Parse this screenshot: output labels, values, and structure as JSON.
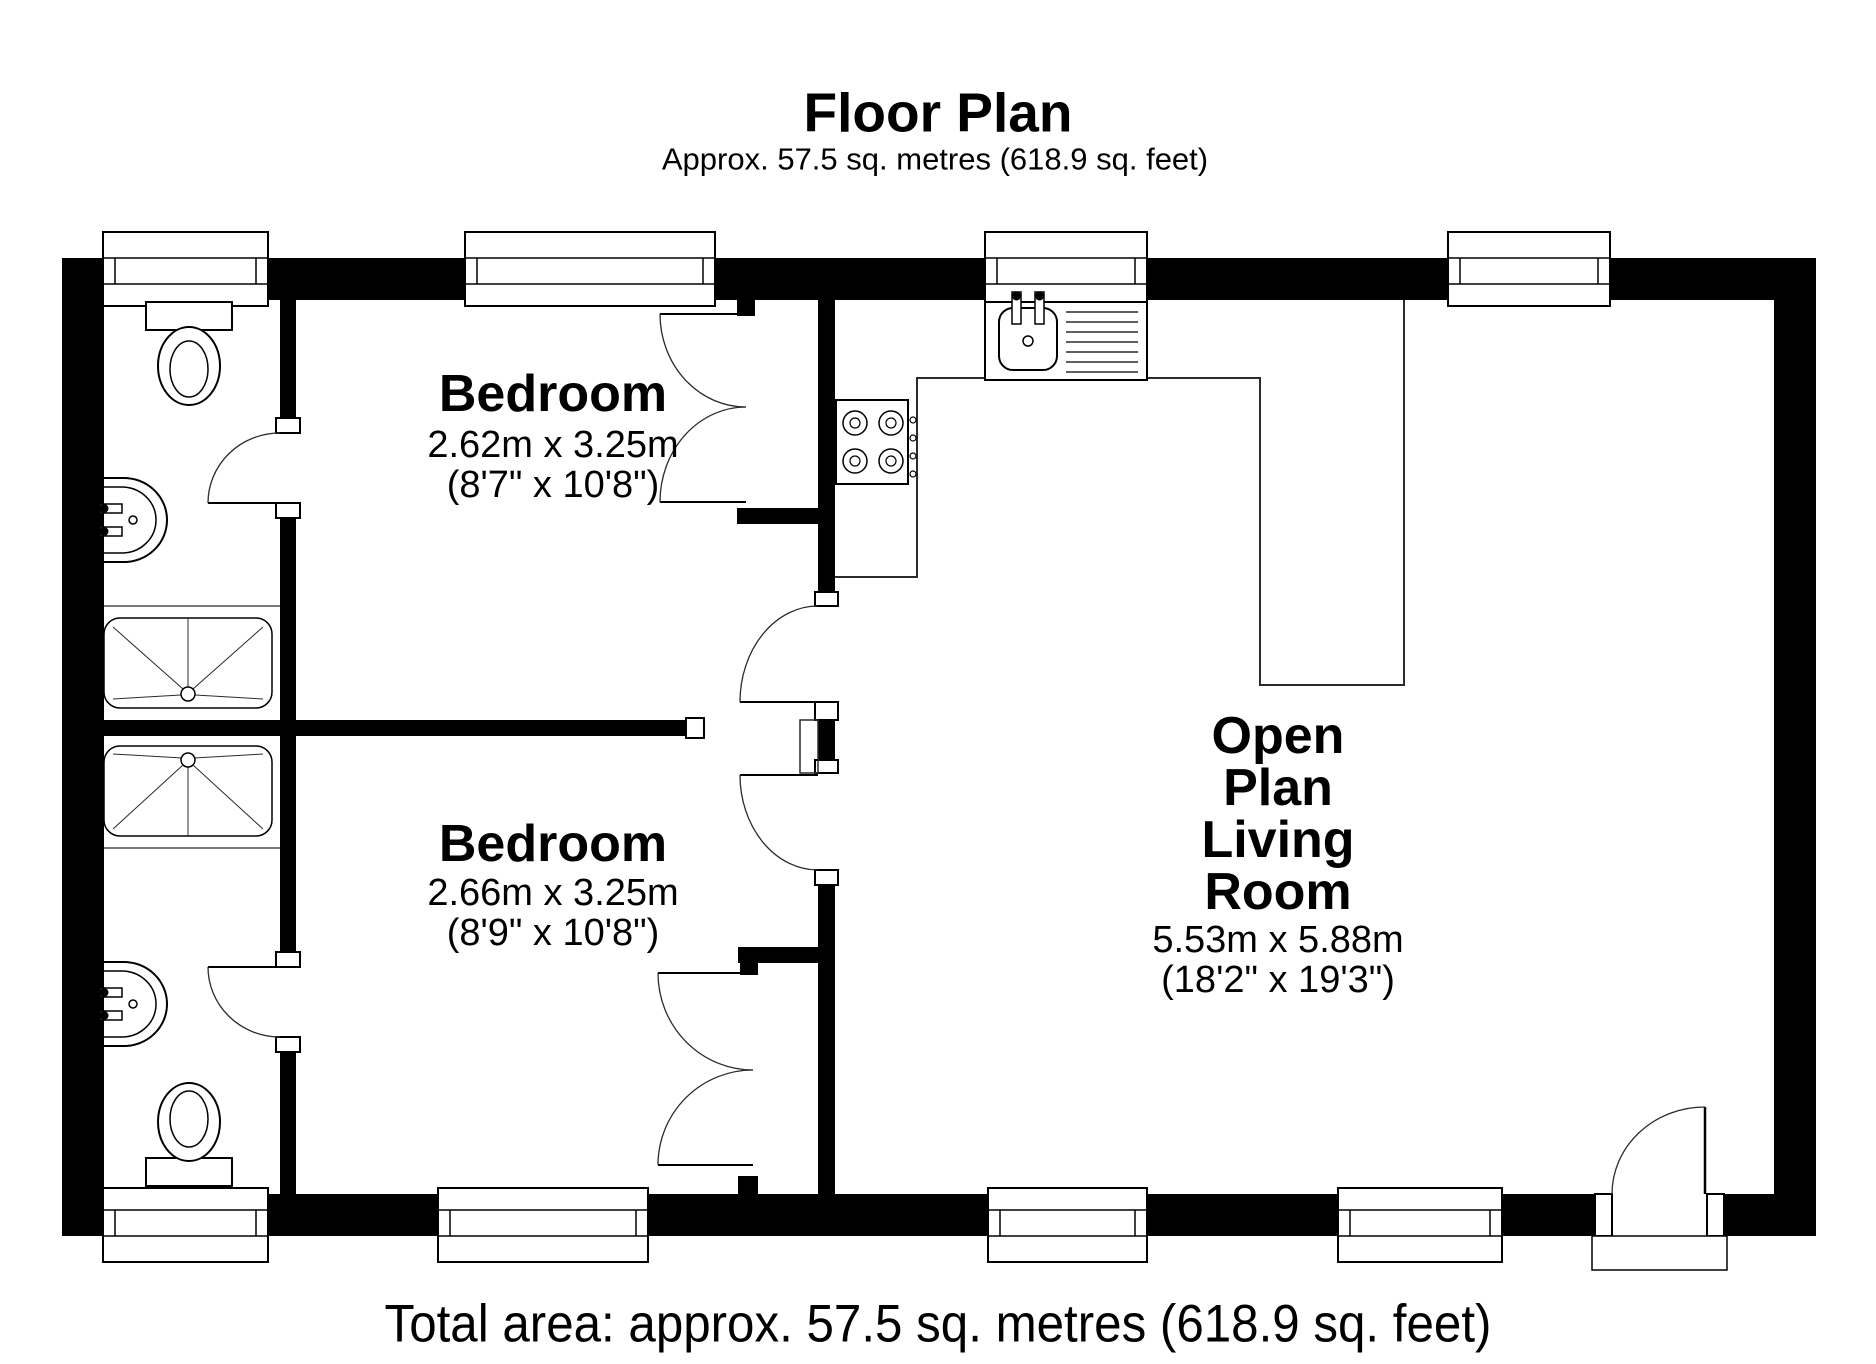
{
  "header": {
    "title": "Floor Plan",
    "subtitle": "Approx. 57.5 sq. metres (618.9 sq. feet)"
  },
  "footer": {
    "total_area": "Total area: approx. 57.5 sq. metres (618.9 sq. feet)"
  },
  "rooms": {
    "bedroom_top": {
      "name": "Bedroom",
      "size_metric": "2.62m x 3.25m",
      "size_imperial": "(8'7\" x 10'8\")"
    },
    "bedroom_bottom": {
      "name": "Bedroom",
      "size_metric": "2.66m x 3.25m",
      "size_imperial": "(8'9\" x 10'8\")"
    },
    "living_room": {
      "name_lines": [
        "Open",
        "Plan",
        "Living",
        "Room"
      ],
      "size_metric": "5.53m x 5.88m",
      "size_imperial": "(18'2\" x 19'3\")"
    }
  },
  "fixtures": {
    "bathroom_top": [
      "toilet",
      "basin",
      "shower-tray"
    ],
    "bathroom_bottom": [
      "shower-tray",
      "basin",
      "toilet"
    ],
    "kitchen": [
      "sink-with-drainer",
      "hob-4-ring",
      "worktop"
    ],
    "doors": [
      "entrance-door",
      "bedroom-door-top",
      "bedroom-door-bottom",
      "bathroom-door-top",
      "bathroom-door-bottom",
      "closet-double-doors-top",
      "closet-double-doors-bottom"
    ],
    "windows_top_wall": 4,
    "windows_bottom_wall": 4
  },
  "colors": {
    "wall": "#000000",
    "line": "#2b2b2b",
    "background": "#ffffff"
  }
}
